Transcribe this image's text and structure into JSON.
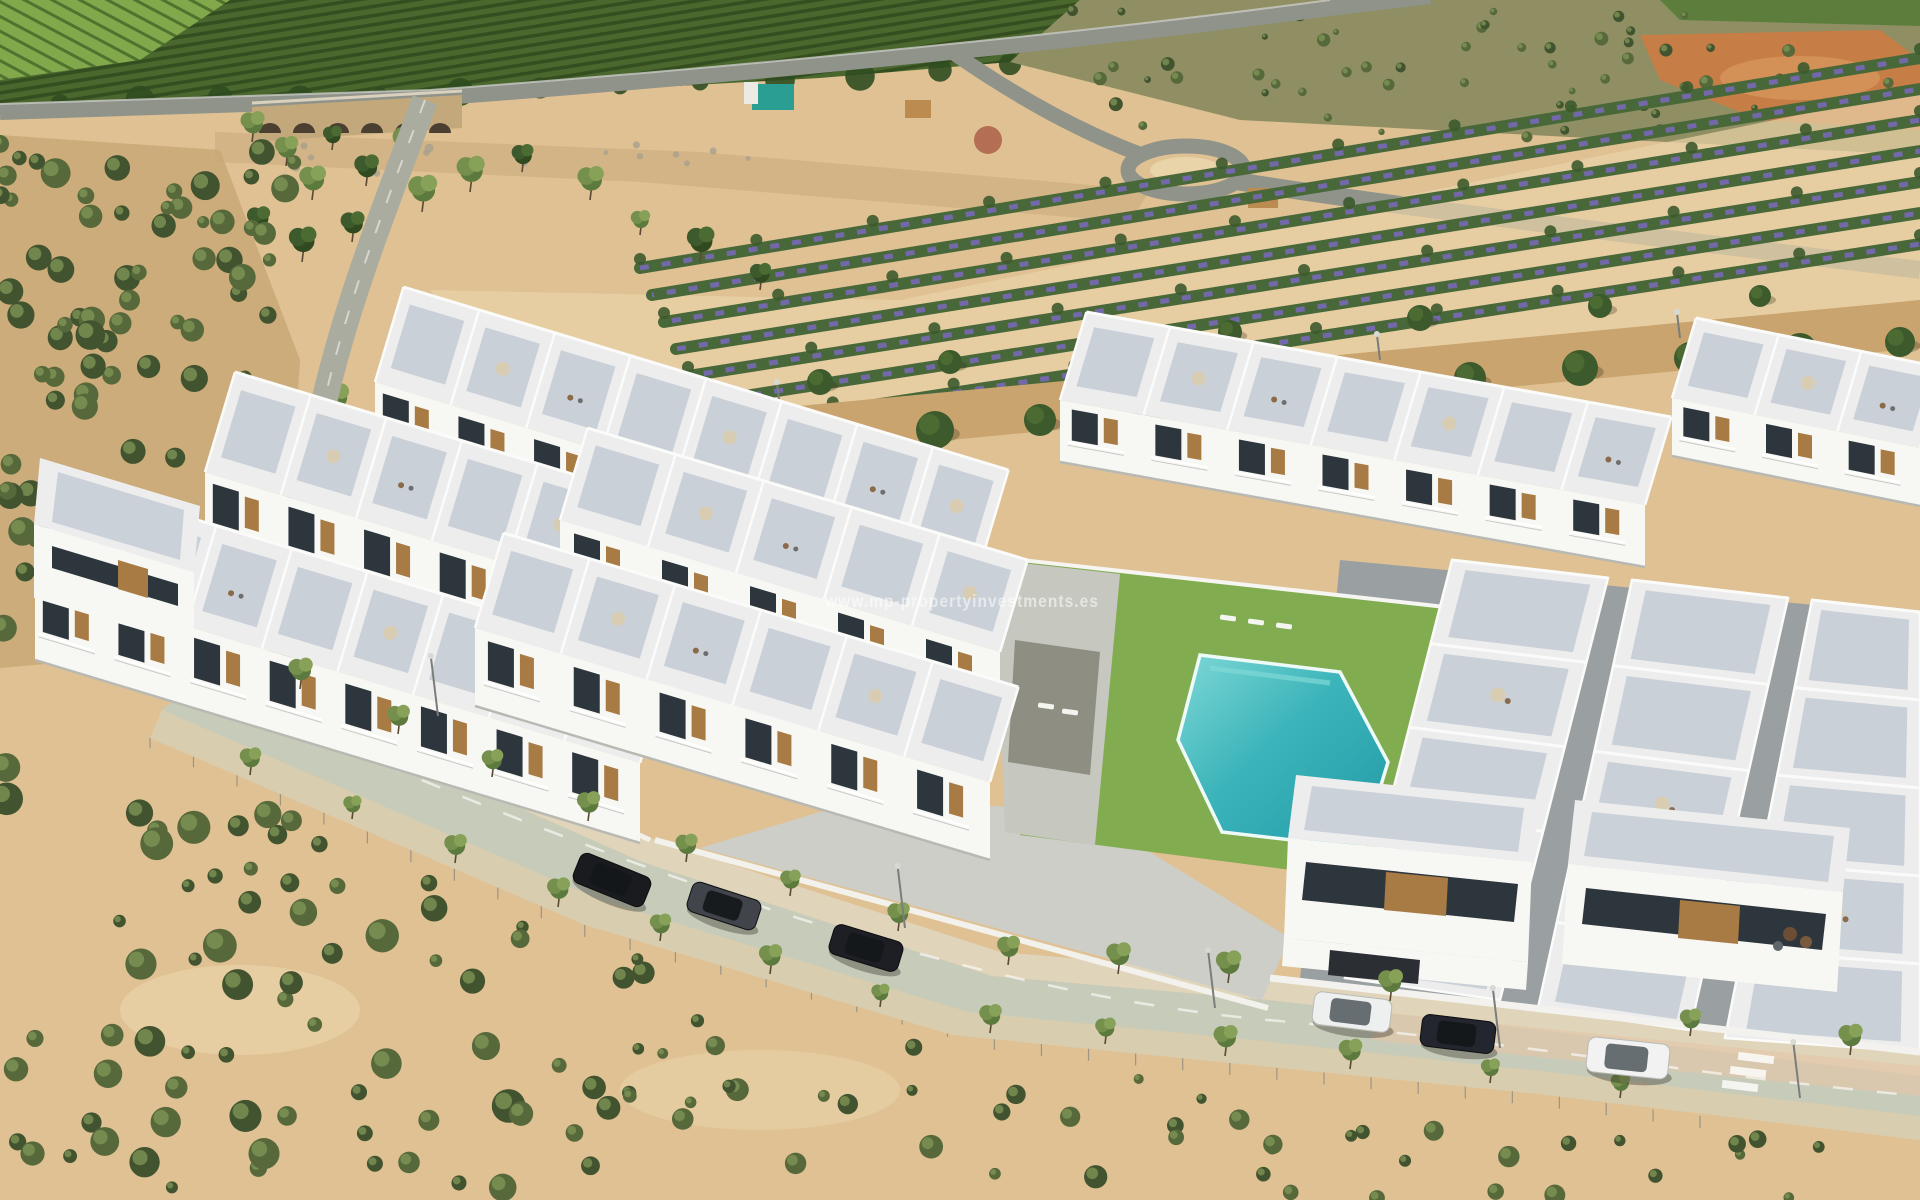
{
  "watermark": {
    "text": "www.mp-propertyinvestments.es"
  },
  "palette": {
    "sandBase": "#dfc193",
    "sandPale": "#e9d3a8",
    "sandDark": "#c9a876",
    "dirtPath": "#c9a46e",
    "orchard": "#4a682e",
    "orchardRow": "#33511f",
    "orchardLight": "#7da049",
    "vineyard": "#82a84c",
    "scrubHill": "#8f8f63",
    "bushDark": "#42532f",
    "bushMid": "#57693b",
    "bushLight": "#7d9355",
    "roadTop": "#8f938a",
    "roadMain": "#c7ccba",
    "roadLight": "#d8d4bd",
    "sidewalk": "#e0d5ba",
    "sidewalkLow": "#d9cdb0",
    "sidewalkPink": "#e3c6a8",
    "bridgeStone": "#c3a87c",
    "archDark": "#4a3f30",
    "riverbed": "#d3b486",
    "stone": "#a8a08f",
    "white": "#f7f7f4",
    "buildingShade": "#e6e6e2",
    "roofWhite": "#ededee",
    "deckTile": "#c6cdd5",
    "deckWarm": "#c4c5bd",
    "wallGray": "#9aa0a2",
    "glass": "#2e363d",
    "wood": "#a87b44",
    "parasol": "#d8cdb2",
    "lawn": "#81ac50",
    "poolDeep": "#229aa6",
    "poolMain": "#3bb4ba",
    "poolLight": "#7fd8d6",
    "poolCoping": "#eefaf8",
    "flowerGreen": "#49683a",
    "flowerPurple": "#7568b0",
    "treeOlive": "#75904c",
    "treeDark": "#3c5a2c",
    "trunk": "#5a4a33",
    "excavation": "#c67d46",
    "terracotta": "#ad5f49",
    "container": "#2a9e92",
    "hut": "#bb8b50",
    "lamp": "#7a7d7b",
    "fence": "#8b8b7f",
    "watermark": "rgba(255,255,255,0.55)"
  },
  "scene": {
    "villa_rows": [
      {
        "x1": 375,
        "y1": 382,
        "x2": 980,
        "y2": 565,
        "fh": 75,
        "rd": 95,
        "n": 8
      },
      {
        "x1": 1672,
        "y1": 398,
        "x2": 1920,
        "y2": 448,
        "fh": 58,
        "rd": 80,
        "n": 3
      },
      {
        "x1": 1060,
        "y1": 400,
        "x2": 1645,
        "y2": 505,
        "fh": 62,
        "rd": 88,
        "n": 7
      },
      {
        "x1": 205,
        "y1": 472,
        "x2": 810,
        "y2": 655,
        "fh": 78,
        "rd": 100,
        "n": 8
      },
      {
        "x1": 560,
        "y1": 520,
        "x2": 1000,
        "y2": 652,
        "fh": 76,
        "rd": 92,
        "n": 5
      },
      {
        "x1": 35,
        "y1": 580,
        "x2": 640,
        "y2": 763,
        "fh": 80,
        "rd": 100,
        "n": 8
      },
      {
        "x1": 475,
        "y1": 628,
        "x2": 990,
        "y2": 782,
        "fh": 78,
        "rd": 95,
        "n": 6
      }
    ],
    "terrace_strips": [
      {
        "pts": [
          [
            1452,
            560
          ],
          [
            1608,
            578
          ],
          [
            1500,
            1000
          ],
          [
            1345,
            978
          ]
        ],
        "cells": 5,
        "parasols": [
          1,
          3
        ]
      },
      {
        "pts": [
          [
            1632,
            580
          ],
          [
            1788,
            598
          ],
          [
            1690,
            1030
          ],
          [
            1538,
            1008
          ]
        ],
        "cells": 5,
        "parasols": [
          2
        ]
      },
      {
        "pts": [
          [
            1812,
            600
          ],
          [
            1920,
            612
          ],
          [
            1920,
            1052
          ],
          [
            1725,
            1038
          ]
        ],
        "cells": 5,
        "parasols": [
          3
        ]
      }
    ],
    "flower_field": {
      "x0": 640,
      "y0": 268,
      "xEnd": 1920,
      "yEnd0": 58,
      "dyL": 27,
      "dyR": 31,
      "rows": 7
    },
    "cars": [
      {
        "name": "black-hatchback",
        "x": 612,
        "y": 880,
        "angle": 22,
        "len": 76,
        "wid": 32,
        "body": "#1a1b1e"
      },
      {
        "name": "dark-gray-car",
        "x": 724,
        "y": 906,
        "angle": 18,
        "len": 72,
        "wid": 31,
        "body": "#41444a"
      },
      {
        "name": "black-car",
        "x": 866,
        "y": 948,
        "angle": 17,
        "len": 72,
        "wid": 31,
        "body": "#1d1f25"
      },
      {
        "name": "white-sedan",
        "x": 1352,
        "y": 1012,
        "angle": 7,
        "len": 78,
        "wid": 33,
        "body": "#eef0ef"
      },
      {
        "name": "dark-blue-hatchback",
        "x": 1458,
        "y": 1034,
        "angle": 7,
        "len": 74,
        "wid": 32,
        "body": "#23262e"
      },
      {
        "name": "white-suv",
        "x": 1628,
        "y": 1058,
        "angle": 6,
        "len": 82,
        "wid": 35,
        "body": "#f1f2f1"
      }
    ],
    "street_trees_upper": [
      [
        300,
        689
      ],
      [
        398,
        734
      ],
      [
        492,
        777
      ],
      [
        588,
        821
      ],
      [
        686,
        862
      ],
      [
        790,
        896
      ],
      [
        898,
        931
      ],
      [
        1008,
        965
      ],
      [
        1118,
        974
      ],
      [
        1228,
        983
      ],
      [
        1390,
        1001
      ],
      [
        1690,
        1036
      ],
      [
        1850,
        1055
      ]
    ],
    "street_trees_lower": [
      [
        250,
        775
      ],
      [
        352,
        819
      ],
      [
        455,
        863
      ],
      [
        558,
        907
      ],
      [
        660,
        941
      ],
      [
        770,
        974
      ],
      [
        880,
        1007
      ],
      [
        990,
        1033
      ],
      [
        1105,
        1044
      ],
      [
        1225,
        1056
      ],
      [
        1350,
        1069
      ],
      [
        1490,
        1083
      ],
      [
        1620,
        1098
      ]
    ],
    "park_trees": [
      [
        252,
        142
      ],
      [
        286,
        166
      ],
      [
        332,
        150
      ],
      [
        312,
        200
      ],
      [
        366,
        186
      ],
      [
        406,
        162
      ],
      [
        258,
        236
      ],
      [
        302,
        262
      ],
      [
        352,
        242
      ],
      [
        422,
        212
      ],
      [
        470,
        192
      ],
      [
        522,
        172
      ],
      [
        590,
        200
      ],
      [
        640,
        235
      ],
      [
        700,
        262
      ],
      [
        760,
        290
      ],
      [
        335,
        418
      ],
      [
        318,
        470
      ],
      [
        305,
        525
      ],
      [
        296,
        575
      ]
    ],
    "lane_pines": [
      [
        620,
        455,
        16
      ],
      [
        720,
        448,
        18
      ],
      [
        830,
        440,
        17
      ],
      [
        935,
        430,
        19
      ],
      [
        1040,
        420,
        16
      ],
      [
        1150,
        408,
        18
      ],
      [
        1255,
        398,
        17
      ],
      [
        1360,
        388,
        19
      ],
      [
        1470,
        378,
        16
      ],
      [
        1580,
        368,
        18
      ],
      [
        1690,
        358,
        16
      ],
      [
        1800,
        350,
        17
      ],
      [
        1900,
        342,
        15
      ],
      [
        700,
        398,
        12
      ],
      [
        820,
        382,
        13
      ],
      [
        950,
        362,
        12
      ],
      [
        1090,
        346,
        13
      ],
      [
        1230,
        332,
        12
      ],
      [
        1420,
        318,
        13
      ],
      [
        1600,
        306,
        12
      ],
      [
        1760,
        296,
        11
      ]
    ],
    "lamps": [
      [
        438,
        716,
        60
      ],
      [
        905,
        928,
        62
      ],
      [
        1215,
        1008,
        58
      ],
      [
        1500,
        1048,
        60
      ],
      [
        1800,
        1098,
        56
      ]
    ],
    "lane_lamps": [
      [
        780,
        408,
        26
      ],
      [
        1080,
        384,
        26
      ],
      [
        1380,
        360,
        26
      ],
      [
        1680,
        338,
        26
      ]
    ],
    "loungers": [
      [
        1228,
        618,
        8
      ],
      [
        1256,
        622,
        8
      ],
      [
        1284,
        626,
        8
      ],
      [
        1046,
        706,
        8
      ],
      [
        1070,
        712,
        8
      ],
      [
        96,
        480,
        20
      ],
      [
        118,
        488,
        20
      ],
      [
        140,
        496,
        20
      ],
      [
        162,
        504,
        20
      ]
    ],
    "bush_zones": [
      {
        "x": 0,
        "y": 700,
        "w": 600,
        "h": 500,
        "n": 85,
        "rmin": 6,
        "rmax": 17,
        "clip": true
      },
      {
        "x": 560,
        "y": 950,
        "w": 680,
        "h": 240,
        "n": 40,
        "rmin": 5,
        "rmax": 12,
        "clip": true
      },
      {
        "x": 1200,
        "y": 1130,
        "w": 640,
        "h": 70,
        "n": 20,
        "rmin": 5,
        "rmax": 11,
        "clip": false
      },
      {
        "x": 0,
        "y": 140,
        "w": 295,
        "h": 515,
        "n": 95,
        "rmin": 6,
        "rmax": 15,
        "clip": false
      },
      {
        "x": 1060,
        "y": 8,
        "w": 850,
        "h": 130,
        "n": 55,
        "rmin": 3,
        "rmax": 7,
        "clip": false
      }
    ],
    "fence_line": [
      [
        150,
        744
      ],
      [
        585,
        931
      ],
      [
        952,
        1041
      ],
      [
        1240,
        1070
      ],
      [
        1540,
        1100
      ],
      [
        1700,
        1122
      ]
    ],
    "tree_blob_line": [
      [
        60,
        104
      ],
      [
        140,
        100
      ],
      [
        220,
        98
      ],
      [
        300,
        100
      ],
      [
        380,
        96
      ],
      [
        460,
        92
      ],
      [
        540,
        88
      ],
      [
        620,
        86
      ],
      [
        700,
        82
      ],
      [
        780,
        80
      ],
      [
        860,
        76
      ],
      [
        940,
        70
      ],
      [
        1010,
        64
      ]
    ]
  }
}
